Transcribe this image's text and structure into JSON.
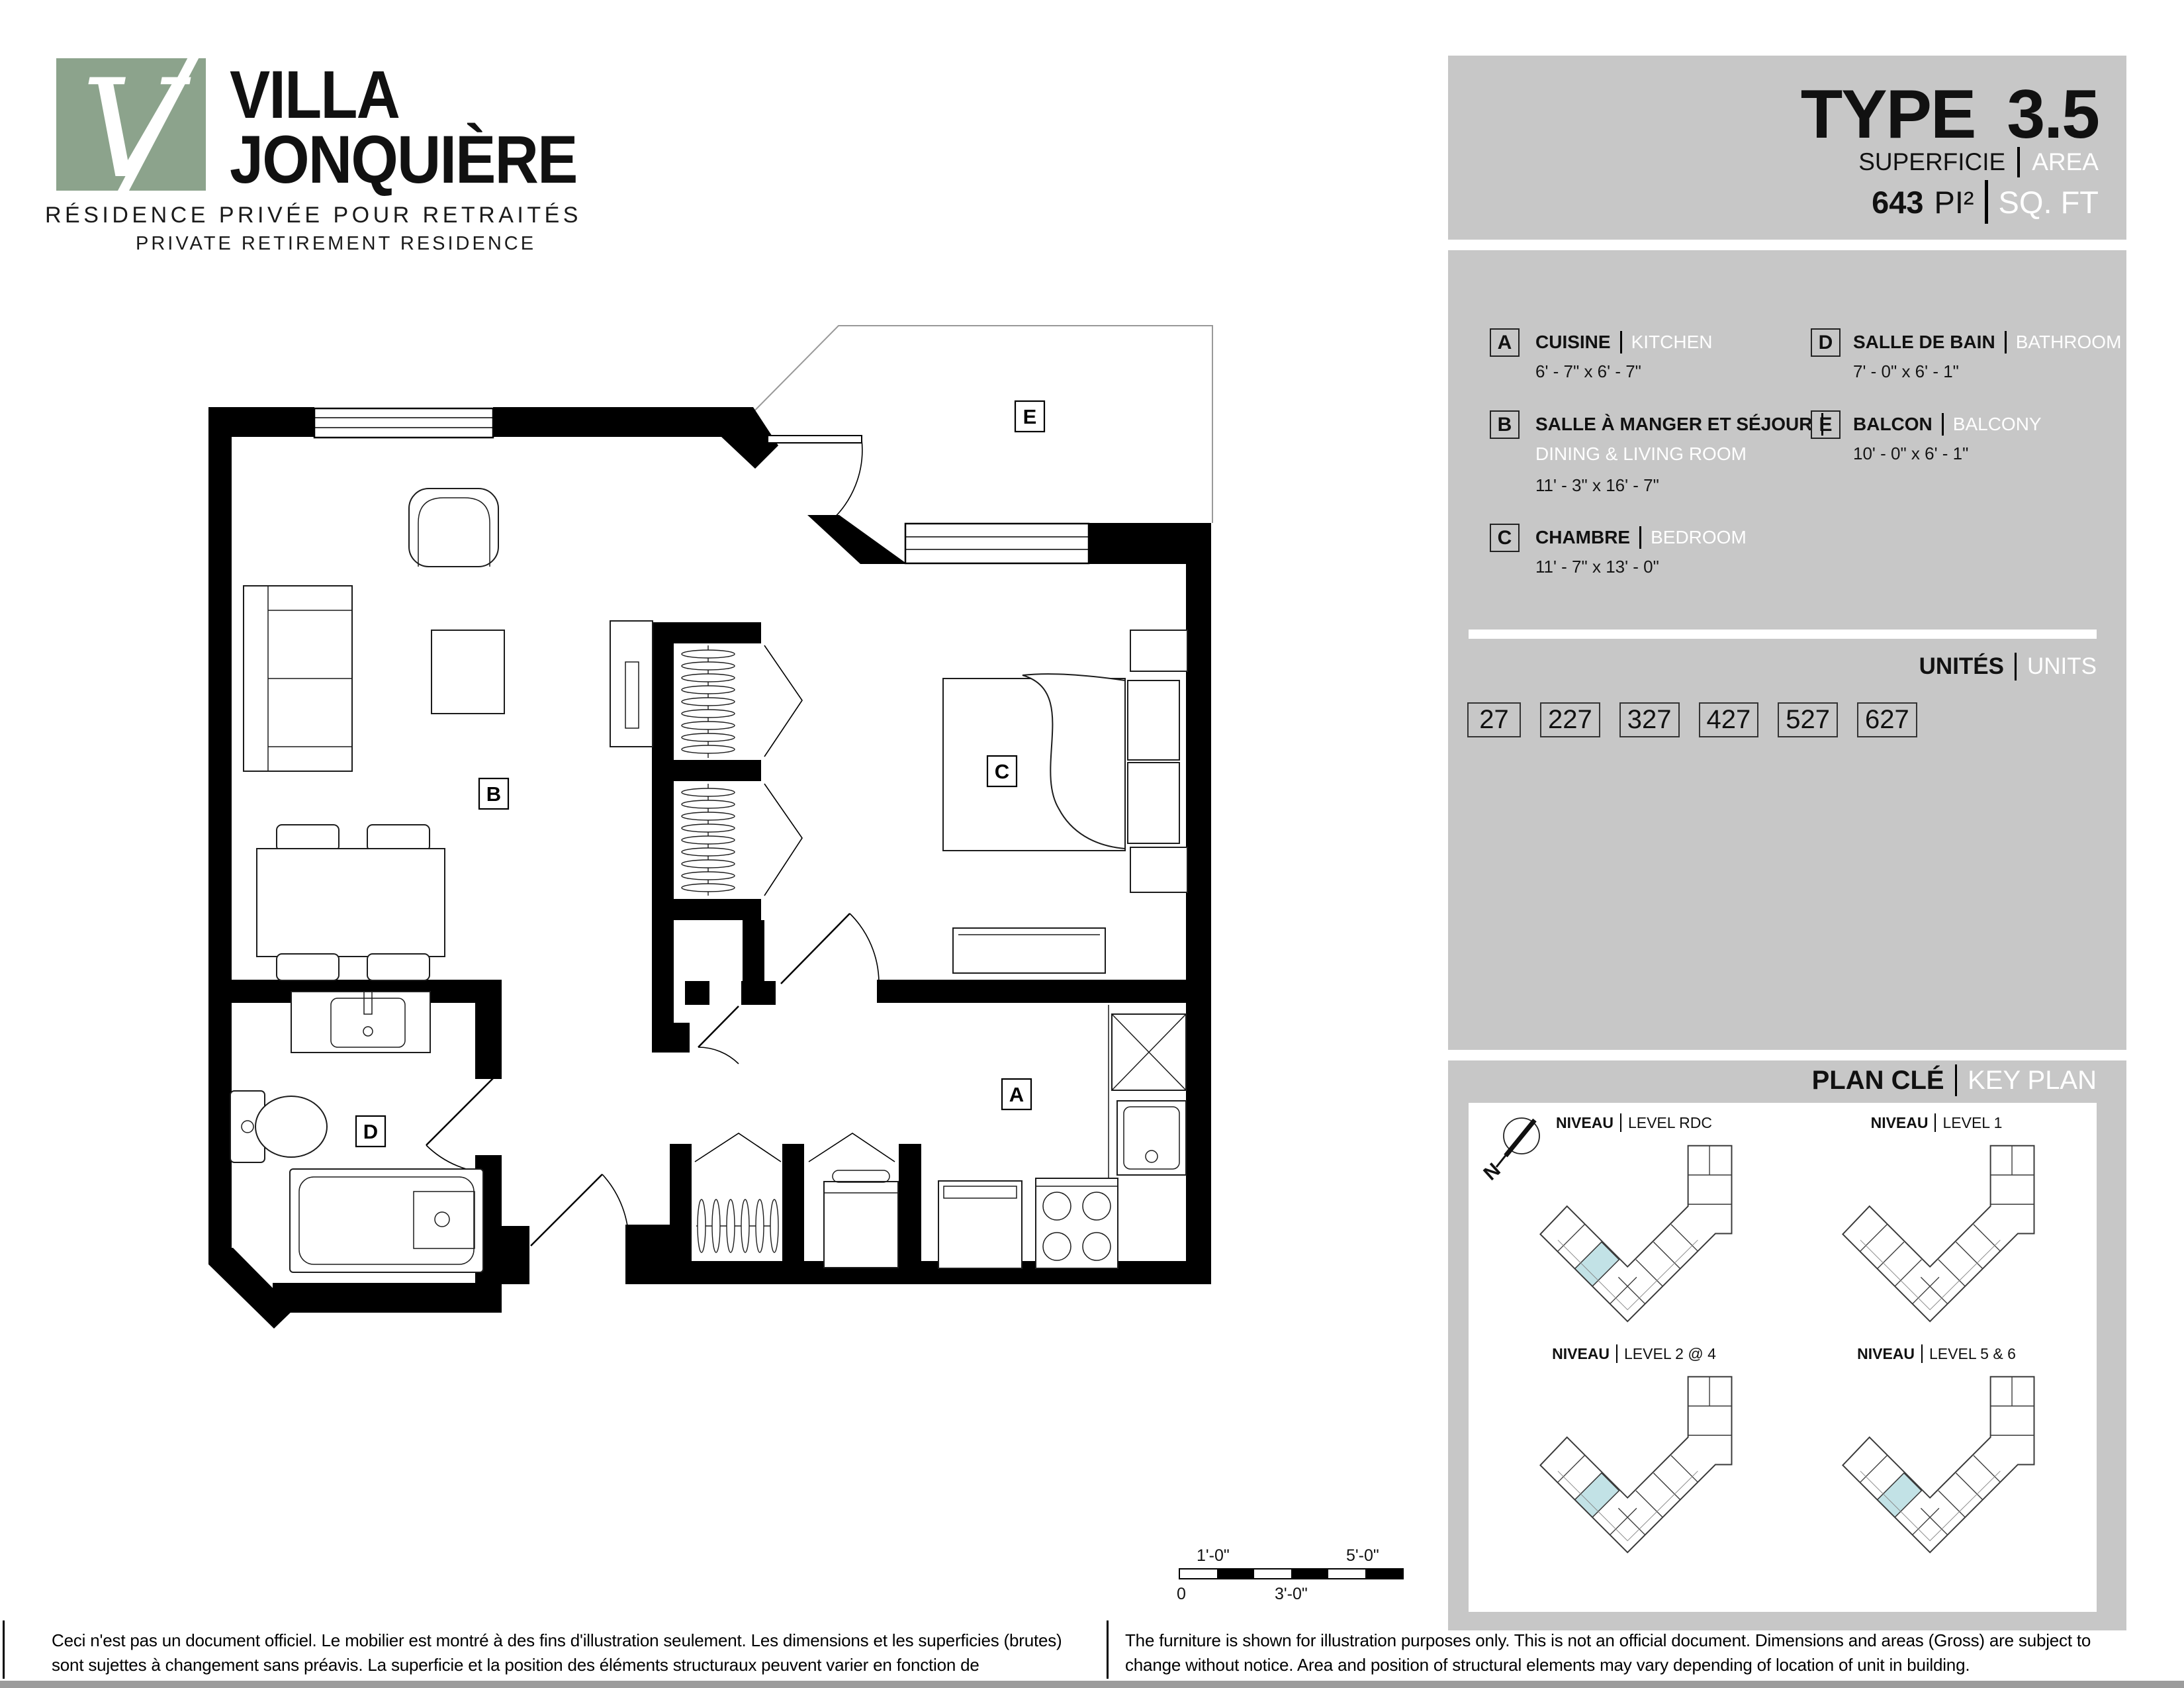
{
  "logo": {
    "name_line1": "VILLA",
    "name_line2": "JONQUIÈRE",
    "subtitle_fr": "RÉSIDENCE PRIVÉE POUR RETRAITÉS",
    "subtitle_en": "PRIVATE RETIREMENT RESIDENCE",
    "mark_letter": "V"
  },
  "header": {
    "type_label": "TYPE",
    "type_value": "3.5",
    "area_label_fr": "SUPERFICIE",
    "area_label_en": "AREA",
    "area_value": "643",
    "area_unit_fr": "PI²",
    "area_unit_en": "SQ. FT"
  },
  "legend": {
    "rooms": [
      {
        "letter": "A",
        "name_fr": "CUISINE",
        "name_en": "KITCHEN",
        "dims": "6' - 7\" x 6' - 7\""
      },
      {
        "letter": "B",
        "name_fr": "SALLE À MANGER ET SÉJOUR",
        "name_en": "DINING & LIVING ROOM",
        "dims": "11' - 3\" x 16' - 7\""
      },
      {
        "letter": "C",
        "name_fr": "CHAMBRE",
        "name_en": "BEDROOM",
        "dims": "11' - 7\" x 13' - 0\""
      },
      {
        "letter": "D",
        "name_fr": "SALLE DE BAIN",
        "name_en": "BATHROOM",
        "dims": "7' - 0\" x 6' - 1\""
      },
      {
        "letter": "E",
        "name_fr": "BALCON",
        "name_en": "BALCONY",
        "dims": "10' - 0\" x 6' - 1\""
      }
    ],
    "units_label_fr": "UNITÉS",
    "units_label_en": "UNITS",
    "units": [
      "27",
      "227",
      "327",
      "427",
      "527",
      "627"
    ]
  },
  "keyplan": {
    "title_fr": "PLAN CLÉ",
    "title_en": "KEY PLAN",
    "north_letter": "N",
    "levels": [
      {
        "label_fr": "NIVEAU",
        "label_en": "LEVEL RDC",
        "highlighted": true
      },
      {
        "label_fr": "NIVEAU",
        "label_en": "LEVEL 1",
        "highlighted": false
      },
      {
        "label_fr": "NIVEAU",
        "label_en": "LEVEL 2 @ 4",
        "highlighted": true
      },
      {
        "label_fr": "NIVEAU",
        "label_en": "LEVEL 5 & 6",
        "highlighted": true
      }
    ]
  },
  "scalebar": {
    "top_left": "1'-0\"",
    "top_right": "5'-0\"",
    "bottom_left": "0",
    "bottom_mid": "3'-0\""
  },
  "footer": {
    "disclaimer_fr": "Ceci n'est pas un document officiel.  Le mobilier est montré à des fins d'illustration seulement.  Les dimensions et les superficies (brutes) sont sujettes à changement sans préavis. La superficie et la position des éléments structuraux peuvent varier en fonction de l'emplacement de l'unité dans le bâtiment.",
    "disclaimer_en": "The furniture is shown for illustration purposes only.  This is not an official document.  Dimensions and areas (Gross) are subject to change without notice.  Area and position of structural elements may vary depending of location of unit in building."
  },
  "colors": {
    "panel_gray": "#c7c7c7",
    "logo_green": "#8ca38c",
    "keyplan_highlight": "#c2e2e6",
    "bottom_bar": "#9c9c9c"
  }
}
